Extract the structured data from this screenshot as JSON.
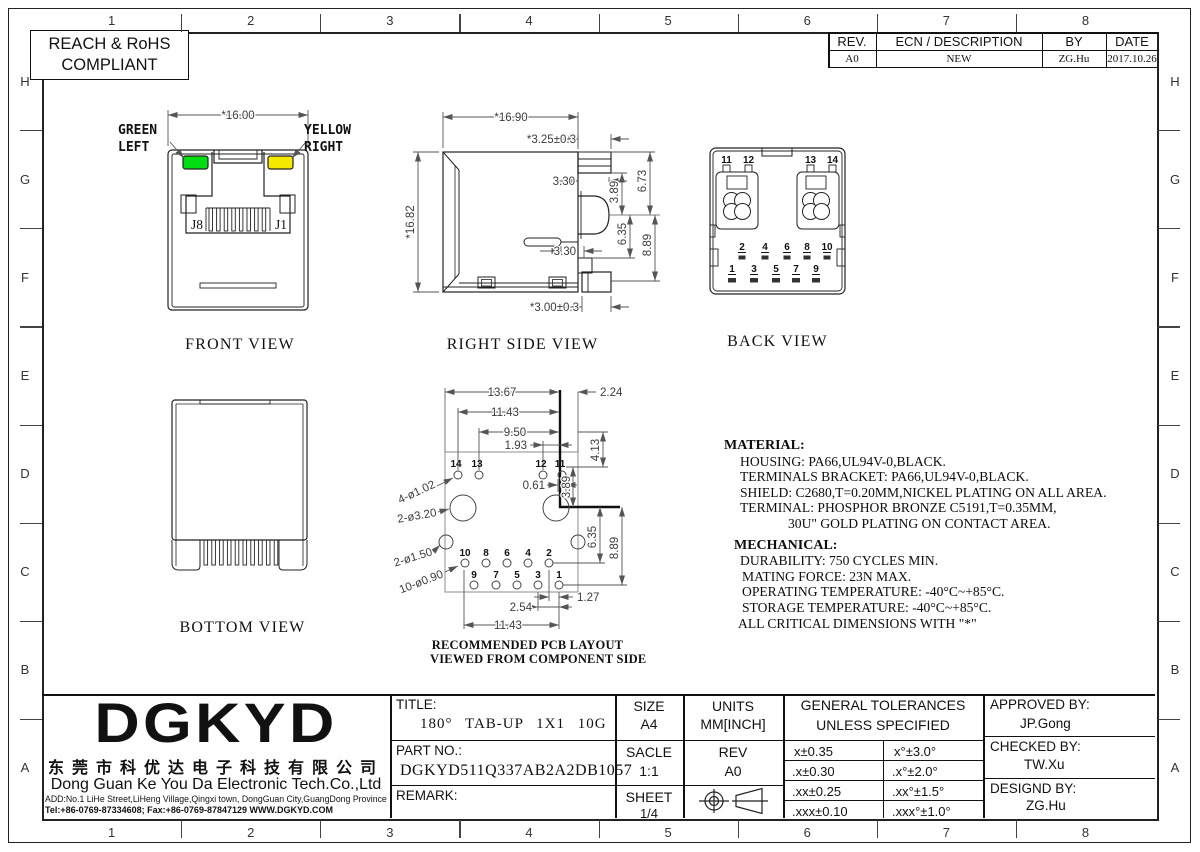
{
  "page": {
    "grid_columns": [
      "1",
      "2",
      "3",
      "4",
      "5",
      "6",
      "7",
      "8"
    ],
    "grid_rows": [
      "H",
      "G",
      "F",
      "E",
      "D",
      "C",
      "B",
      "A"
    ],
    "compliance_badge": {
      "line1": "REACH & RoHS",
      "line2": "COMPLIANT"
    }
  },
  "revision_table": {
    "headers": {
      "rev": "REV.",
      "ecn": "ECN / DESCRIPTION",
      "by": "BY",
      "date": "DATE"
    },
    "row": {
      "rev": "A0",
      "ecn": "NEW",
      "by": "ZG.Hu",
      "date": "2017.10.26"
    }
  },
  "views": {
    "front": {
      "caption": "FRONT VIEW",
      "dim_width": "*16.00",
      "led_labels": {
        "left_color": "GREEN",
        "left_pos": "LEFT",
        "right_color": "YELLOW",
        "right_pos": "RIGHT"
      },
      "jack_labels": {
        "left": "J8",
        "right": "J1"
      },
      "led_colors": {
        "green": "#00DD12",
        "yellow": "#F5E800"
      }
    },
    "right_side": {
      "caption": "RIGHT SIDE VIEW",
      "dims": {
        "width": "*16.90",
        "height": "*16.82",
        "tab_top": "*3.25±0.3",
        "d330_top": "3.30",
        "d389": "3.89",
        "d673": "6.73",
        "d635": "6.35",
        "d889": "8.89",
        "d330_bottom": "3.30",
        "tab_bottom": "*3.00±0.3"
      }
    },
    "back": {
      "caption": "BACK VIEW",
      "top_row": [
        "11",
        "12",
        "13",
        "14"
      ],
      "upper_row": [
        "2",
        "4",
        "6",
        "8",
        "10"
      ],
      "lower_row": [
        "1",
        "3",
        "5",
        "7",
        "9"
      ]
    },
    "bottom": {
      "caption": "BOTTOM VIEW"
    },
    "pcb": {
      "caption_line1": "RECOMMENDED PCB LAYOUT",
      "caption_line2": "VIEWED FROM COMPONENT SIDE",
      "dims": {
        "d1367": "13.67",
        "d1143_top": "11.43",
        "d950": "9.50",
        "d193": "1.93",
        "d224": "2.24",
        "d413": "4.13",
        "d389": "3.89",
        "d061": "0.61",
        "d635": "6.35",
        "d889": "8.89",
        "d127": "1.27",
        "d254": "2.54",
        "d1143_bottom": "11.43"
      },
      "callouts": {
        "c102": "4-ø1.02",
        "c320": "2-ø3.20",
        "c150": "2-ø1.50",
        "c090": "10-ø0.90"
      },
      "holes_top": [
        "14",
        "13",
        "12",
        "11"
      ],
      "holes_upper": [
        "10",
        "8",
        "6",
        "4",
        "2"
      ],
      "holes_lower": [
        "9",
        "7",
        "5",
        "3",
        "1"
      ]
    }
  },
  "notes": {
    "material_title": "MATERIAL:",
    "material_lines": [
      "HOUSING: PA66,UL94V-0,BLACK.",
      "TERMINALS BRACKET: PA66,UL94V-0,BLACK.",
      "SHIELD: C2680,T=0.20MM,NICKEL PLATING ON ALL AREA.",
      "TERMINAL: PHOSPHOR BRONZE C5191,T=0.35MM,",
      "30U\" GOLD PLATING ON CONTACT AREA."
    ],
    "mechanical_title": "MECHANICAL:",
    "mechanical_lines": [
      "DURABILITY: 750 CYCLES MIN.",
      "MATING FORCE: 23N MAX.",
      "OPERATING TEMPERATURE: -40°C~+85°C.",
      "STORAGE TEMPERATURE: -40°C~+85°C.",
      "ALL CRITICAL DIMENSIONS WITH \"*\""
    ]
  },
  "title_block": {
    "logo": "DGKYD",
    "company_cn": "东莞市科优达电子科技有限公司",
    "company_en": "Dong Guan Ke You Da Electronic Tech.Co.,Ltd",
    "address": "ADD:No.1 LiHe Street,LiHeng Village,Qingxi town, DongGuan City,GuangDong Province",
    "contact": "Tel:+86-0769-87334608; Fax:+86-0769-87847129  WWW.DGKYD.COM",
    "title_label": "TITLE:",
    "title_value": "180°  TAB-UP  1X1  10G",
    "part_label": "PART NO.:",
    "part_value": "DGKYD511Q337AB2A2DB1057",
    "remark_label": "REMARK:",
    "size_label": "SIZE",
    "size_value": "A4",
    "units_label": "UNITS",
    "units_value": "MM[INCH]",
    "scale_label": "SACLE",
    "scale_value": "1:1",
    "rev_label": "REV",
    "rev_value": "A0",
    "sheet_label": "SHEET",
    "sheet_value": "1/4",
    "tol_header1": "GENERAL TOLERANCES",
    "tol_header2": "UNLESS SPECIFIED",
    "tol_linear": [
      "x±0.35",
      ".x±0.30",
      ".xx±0.25",
      ".xxx±0.10"
    ],
    "tol_angular": [
      "x°±3.0°",
      ".x°±2.0°",
      ".xx°±1.5°",
      ".xxx°±1.0°"
    ],
    "approved_label": "APPROVED BY:",
    "approved_value": "JP.Gong",
    "checked_label": "CHECKED BY:",
    "checked_value": "TW.Xu",
    "designed_label": "DESIGND BY:",
    "designed_value": "ZG.Hu"
  }
}
